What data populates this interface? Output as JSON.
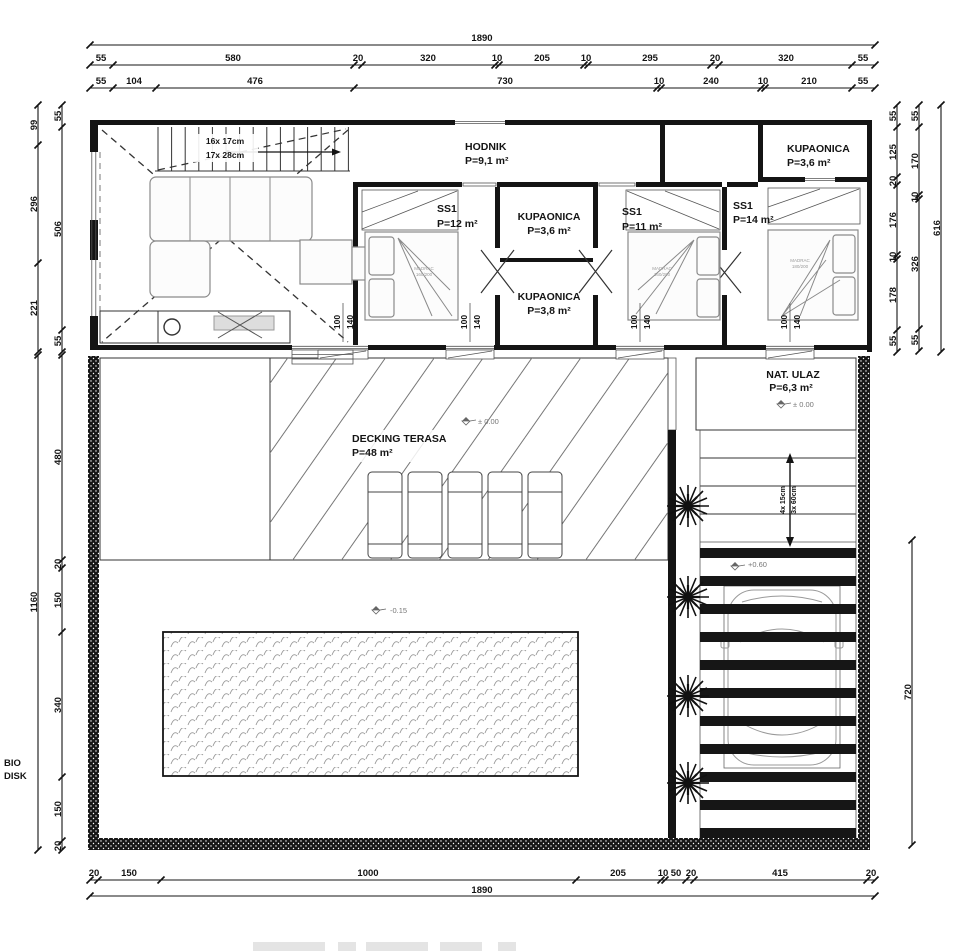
{
  "rooms": {
    "hodnik": {
      "name": "HODNIK",
      "area": "P=9,1 m²"
    },
    "kupaonica_top": {
      "name": "KUPAONICA",
      "area": "P=3,6 m²"
    },
    "ss1_12": {
      "name": "SS1",
      "area": "P=12 m²"
    },
    "kupaonica_36": {
      "name": "KUPAONICA",
      "area": "P=3,6 m²"
    },
    "kupaonica_38": {
      "name": "KUPAONICA",
      "area": "P=3,8 m²"
    },
    "ss1_11": {
      "name": "SS1",
      "area": "P=11 m²"
    },
    "ss1_14": {
      "name": "SS1",
      "area": "P=14 m²"
    },
    "decking": {
      "name": "DECKING TERASA",
      "area": "P=48 m²"
    },
    "nat_ulaz": {
      "name": "NAT. ULAZ",
      "area": "P=6,3 m²"
    }
  },
  "stairs": {
    "line1": "16x 17cm",
    "line2": "17x 28cm"
  },
  "outdoor_steps": {
    "line1": "4x 15cm",
    "line2": "3x 60cm"
  },
  "levels": {
    "deck": "± 0.00",
    "entrance": "± 0.00",
    "pool": "-0.15",
    "carport": "+0.60"
  },
  "window_label": {
    "w": "100",
    "h": "140"
  },
  "beds": {
    "b1": {
      "l1": "MADRAC",
      "l2": "160/200"
    },
    "b2": {
      "l1": "MADRAC",
      "l2": "160/200"
    },
    "b3": {
      "l1": "MADRAC",
      "l2": "180/200"
    }
  },
  "side_note": {
    "line1": "BIO",
    "line2": "DISK"
  },
  "dims": {
    "top_total": "1890",
    "top_row2": [
      "55",
      "580",
      "20",
      "320",
      "10",
      "205",
      "10",
      "295",
      "20",
      "320",
      "55"
    ],
    "top_row3": [
      "55",
      "104",
      "476",
      "730",
      "10",
      "240",
      "10",
      "210",
      "55"
    ],
    "bottom_row": [
      "20",
      "150",
      "1000",
      "205",
      "10",
      "50",
      "20",
      "415",
      "20"
    ],
    "bottom_total": "1890",
    "left_outer_top": [
      "99",
      "296",
      "221"
    ],
    "left_inner_top": [
      "55",
      "506",
      "55"
    ],
    "left_outer_bottom": "1160",
    "left_inner_bottom": [
      "480",
      "20",
      "150",
      "340",
      "150",
      "20"
    ],
    "right_inner": [
      "55",
      "125",
      "20",
      "176",
      "10",
      "178",
      "55"
    ],
    "right_middle": [
      "55",
      "170",
      "10",
      "326",
      "55"
    ],
    "right_outer": "616",
    "right_lower": "720"
  },
  "colors": {
    "ink": "#141414",
    "furniture": "#8a8a8a"
  }
}
